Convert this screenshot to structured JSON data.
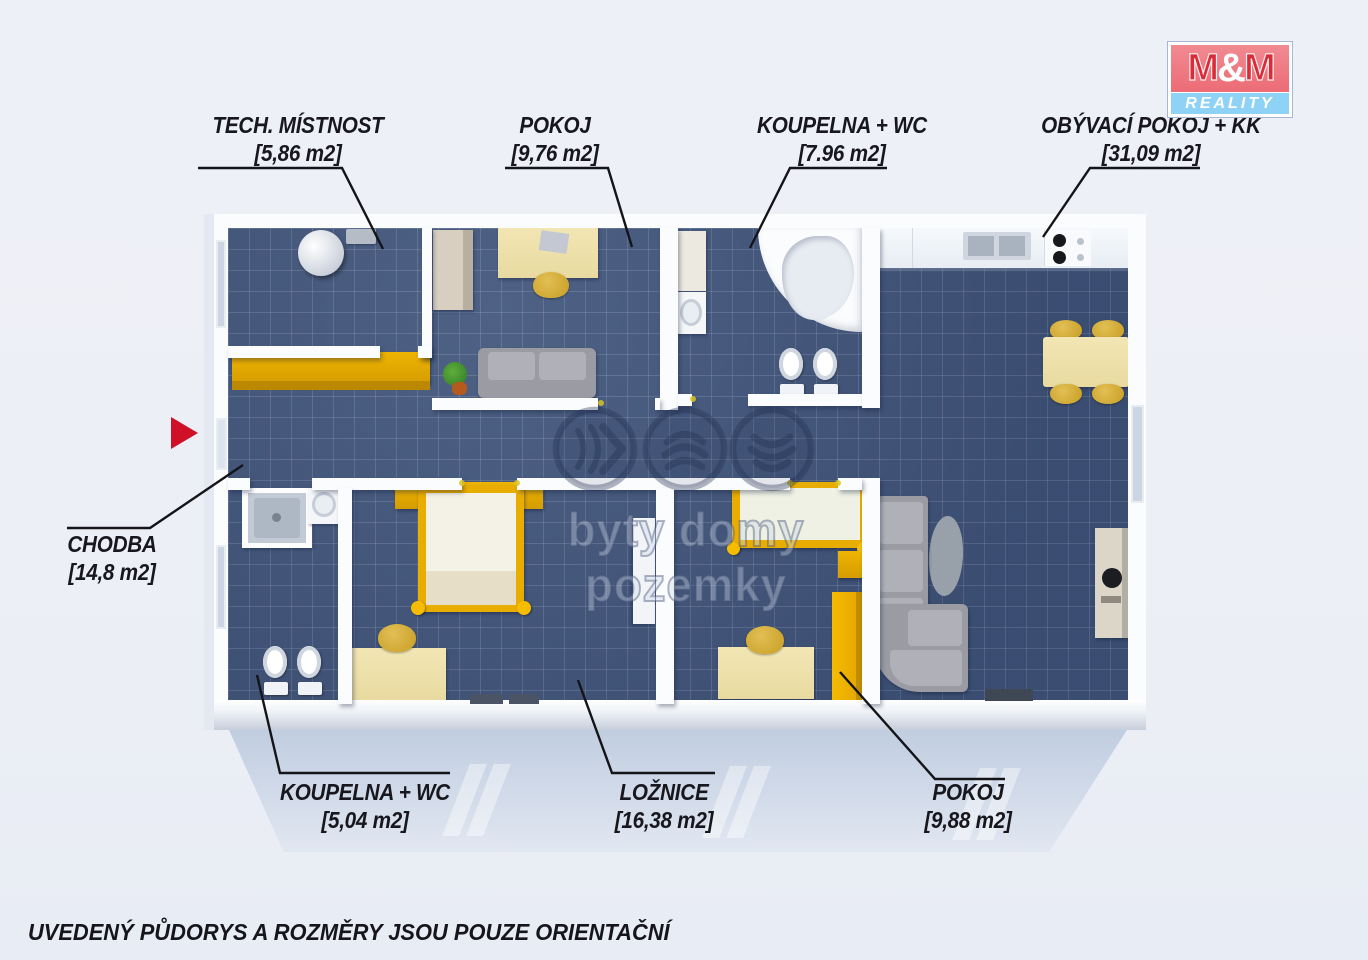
{
  "logo": {
    "m_left": "M",
    "ampersand": "&",
    "m_right": "M",
    "tagline": "REALITY",
    "red": "#ec6c76",
    "blue": "#8ed2f5"
  },
  "rooms": [
    {
      "id": "tech-mistnost",
      "name": "TECH. MÍSTNOST",
      "area": "[5,86 m2]"
    },
    {
      "id": "pokoj-top",
      "name": "POKOJ",
      "area": "[9,76 m2]"
    },
    {
      "id": "koupelna-wc-top",
      "name": "KOUPELNA + WC",
      "area": "[7.96 m2]"
    },
    {
      "id": "obyvaci-pokoj-kk",
      "name": "OBÝVACÍ POKOJ + KK",
      "area": "[31,09 m2]"
    },
    {
      "id": "chodba",
      "name": "CHODBA",
      "area": "[14,8 m2]"
    },
    {
      "id": "koupelna-wc-bottom",
      "name": "KOUPELNA + WC",
      "area": "[5,04 m2]"
    },
    {
      "id": "loznice",
      "name": "LOŽNICE",
      "area": "[16,38 m2]"
    },
    {
      "id": "pokoj-bottom",
      "name": "POKOJ",
      "area": "[9,88 m2]"
    }
  ],
  "watermark": {
    "text": "byty domy pozemky",
    "icons": [
      "waves-right-icon",
      "arcs-up-icon",
      "arcs-down-icon"
    ]
  },
  "disclaimer": "UVEDENÝ PŮDORYS A ROZMĚRY JSOU POUZE ORIENTAČNÍ",
  "colors": {
    "floor_tile": "#41567c",
    "wall": "#fbfcfe",
    "furniture_yellow": "#edb000",
    "furniture_beige": "#f1e4ad",
    "sofa_gray": "#9b9ca3",
    "arrow_red": "#ce1126",
    "label_text": "#17171d"
  }
}
